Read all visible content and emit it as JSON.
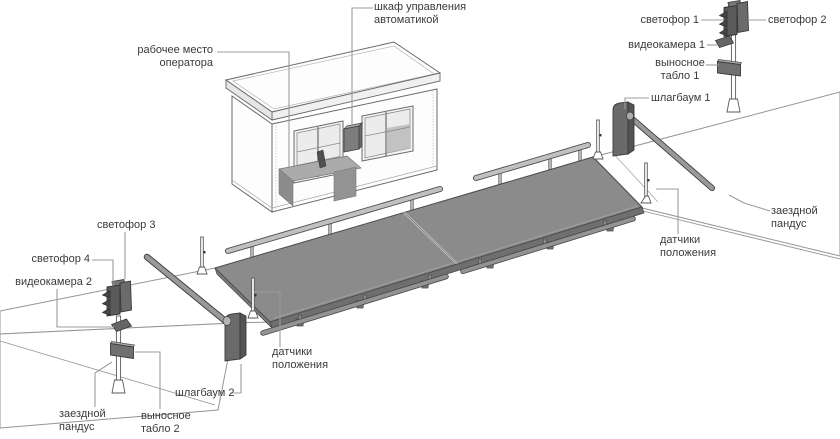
{
  "diagram": {
    "labels": {
      "control_cabinet": "шкаф управления\nавтоматикой",
      "operator_workplace": "рабочее место\nоператора",
      "traffic_light_1": "светофор 1",
      "traffic_light_2": "светофор 2",
      "video_camera_1": "видеокамера 1",
      "remote_display_1": "выносное\nтабло 1",
      "barrier_1": "шлагбаум 1",
      "entry_ramp_right": "заездной\nпандус",
      "position_sensors_right": "датчики\nположения",
      "traffic_light_3": "светофор 3",
      "traffic_light_4": "светофор 4",
      "video_camera_2": "видеокамера 2",
      "entry_ramp_left": "заездной\nпандус",
      "remote_display_2": "выносное\nтабло 2",
      "barrier_2": "шлагбаум 2",
      "position_sensors_left": "датчики\nположения"
    },
    "colors": {
      "platform_top": "#8b8b8b",
      "platform_side": "#6f6f6f",
      "equipment_dark": "#636363",
      "rail_light": "#c0c0c0",
      "outline": "#3f3f3f",
      "ground_line": "#949494",
      "leader_line": "#9c9c9c",
      "label_text": "#3a3a3a",
      "background": "#ffffff"
    }
  }
}
